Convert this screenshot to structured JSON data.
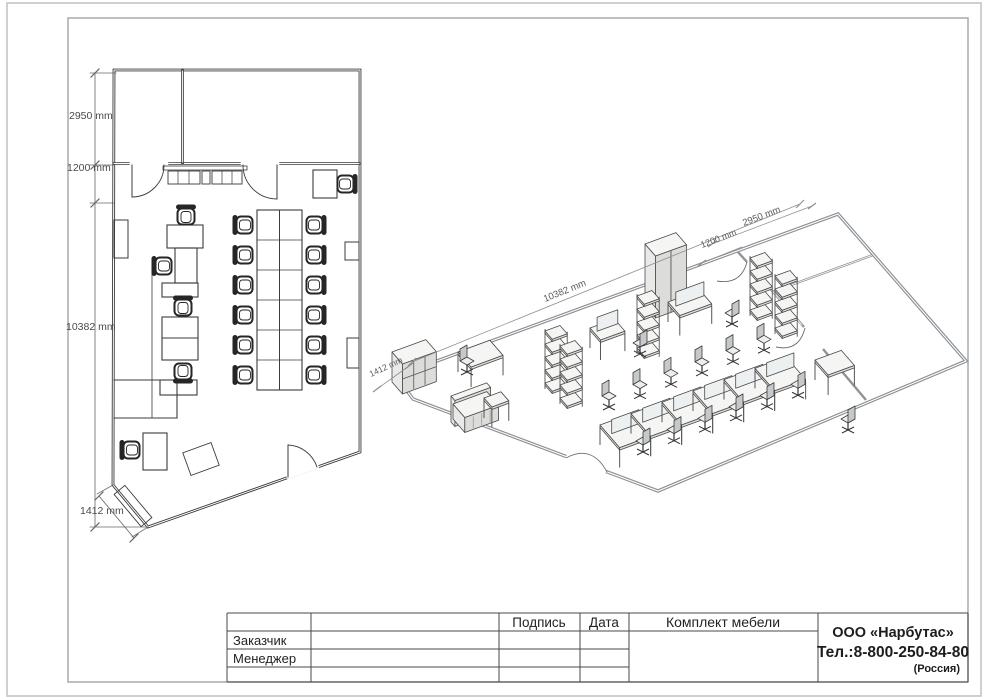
{
  "plan": {
    "dim_top": "2950 mm",
    "dim_reception": "1200 mm",
    "dim_side": "10382 mm",
    "dim_corner": "1412 mm"
  },
  "iso": {
    "dim_side": "10382 mm",
    "dim_corner": "1412 mm",
    "dim_top": "2950 mm",
    "dim_partition": "1200 mm"
  },
  "title_block": {
    "customer_label": "Заказчик",
    "manager_label": "Менеджер",
    "signature_header": "Подпись",
    "date_header": "Дата",
    "project_title": "Комплект мебели",
    "company_name": "ООО «Нарбутас»",
    "company_phone": "Тел.:8-800-250-84-80",
    "company_country": "(Россия)"
  }
}
